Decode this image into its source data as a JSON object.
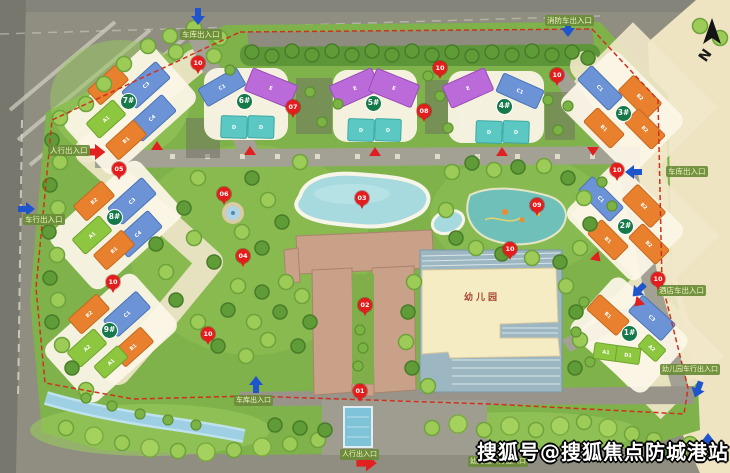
{
  "site_plan": {
    "watermark": "搜狐号@搜狐焦点防城港站",
    "north_label": "N",
    "kindergarten_label": "幼儿园",
    "entrances": [
      {
        "id": "top-garage",
        "label": "车库出入口"
      },
      {
        "id": "top-fire-truck",
        "label": "消防车出入口"
      },
      {
        "id": "left-pedestrian",
        "label": "人行出入口"
      },
      {
        "id": "left-vehicle",
        "label": "车行出入口"
      },
      {
        "id": "right-garage",
        "label": "车库出入口"
      },
      {
        "id": "right-hotel-vehicle",
        "label": "酒店车出入口"
      },
      {
        "id": "right-kindergarten-vehicle",
        "label": "幼儿园车行出入口"
      },
      {
        "id": "bottom-garage",
        "label": "车库出入口"
      },
      {
        "id": "bottom-pedestrian",
        "label": "人行出入口"
      },
      {
        "id": "bottom-kindergarten-pedestrian",
        "label": "幼儿园人行出入口"
      },
      {
        "id": "corner-pedestrian",
        "label": "人行出入口"
      }
    ],
    "buildings": [
      {
        "id": "1#",
        "blocks": [
          "B1",
          "C3",
          "A1",
          "D1",
          "A2"
        ]
      },
      {
        "id": "2#",
        "blocks": [
          "C1",
          "B2",
          "B1",
          "B2"
        ]
      },
      {
        "id": "3#",
        "blocks": [
          "C1",
          "B2",
          "B1",
          "B2"
        ]
      },
      {
        "id": "4#",
        "blocks": [
          "E",
          "C1",
          "D",
          "D"
        ]
      },
      {
        "id": "5#",
        "blocks": [
          "E",
          "E",
          "D",
          "D"
        ]
      },
      {
        "id": "6#",
        "blocks": [
          "C1",
          "E",
          "D",
          "D"
        ]
      },
      {
        "id": "7#",
        "blocks": [
          "B2",
          "C3",
          "A1",
          "C4",
          "B1"
        ]
      },
      {
        "id": "8#",
        "blocks": [
          "B2",
          "C3",
          "A1",
          "C4",
          "B1"
        ]
      },
      {
        "id": "9#",
        "blocks": [
          "B2",
          "C1",
          "A2",
          "B1",
          "A1"
        ]
      }
    ],
    "pins": [
      "01",
      "02",
      "03",
      "04",
      "05",
      "06",
      "07",
      "08",
      "09",
      "10",
      "10",
      "10",
      "10",
      "10",
      "10",
      "10",
      "10"
    ],
    "colors": {
      "block_orange": "#e8802e",
      "block_blue": "#6b93d6",
      "block_green": "#8dc63f",
      "block_purple": "#bb6bd9",
      "block_teal": "#5cc8c4",
      "pin_red": "#e41c1c",
      "building_badge_green": "#15794a",
      "entrance_badge_green": "#6a8c38",
      "boundary_red": "#d0311f",
      "lake_blue": "#a6d9de",
      "hotel_tan": "#c9a189",
      "kindergarten_cream": "#f5ecc4",
      "road_gray": "#8f8e80",
      "site_green": "#7fb24a",
      "beige": "#efe4c2"
    }
  }
}
